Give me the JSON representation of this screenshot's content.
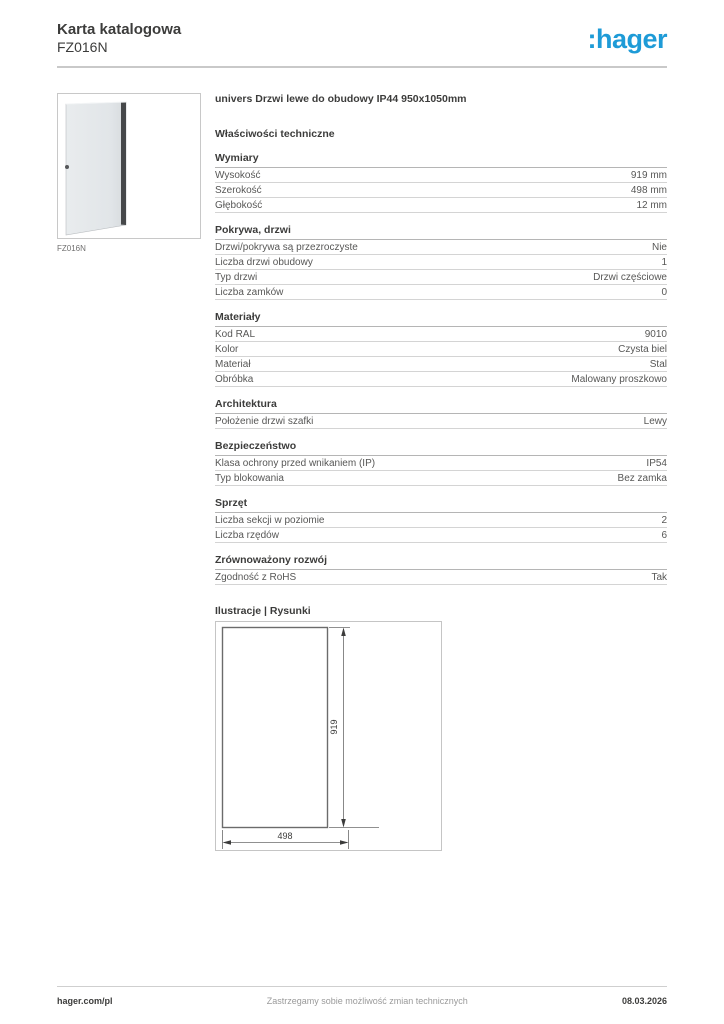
{
  "page": {
    "title": "Karta katalogowa",
    "product_code": "FZ016N",
    "brand": {
      "logo_text": ":hager",
      "color": "#1e9bd7"
    }
  },
  "product": {
    "image_caption": "FZ016N",
    "title": "univers Drzwi lewe do obudowy IP44 950x1050mm"
  },
  "specs": {
    "heading": "Właściwości techniczne",
    "sections": [
      {
        "title": "Wymiary",
        "rows": [
          {
            "label": "Wysokość",
            "value": "919 mm"
          },
          {
            "label": "Szerokość",
            "value": "498 mm"
          },
          {
            "label": "Głębokość",
            "value": "12 mm"
          }
        ]
      },
      {
        "title": "Pokrywa, drzwi",
        "rows": [
          {
            "label": "Drzwi/pokrywa są przezroczyste",
            "value": "Nie"
          },
          {
            "label": "Liczba drzwi obudowy",
            "value": "1"
          },
          {
            "label": "Typ drzwi",
            "value": "Drzwi częściowe"
          },
          {
            "label": "Liczba zamków",
            "value": "0"
          }
        ]
      },
      {
        "title": "Materiały",
        "rows": [
          {
            "label": "Kod RAL",
            "value": "9010"
          },
          {
            "label": "Kolor",
            "value": "Czysta biel"
          },
          {
            "label": "Materiał",
            "value": "Stal"
          },
          {
            "label": "Obróbka",
            "value": "Malowany proszkowo"
          }
        ]
      },
      {
        "title": "Architektura",
        "rows": [
          {
            "label": "Położenie drzwi szafki",
            "value": "Lewy"
          }
        ]
      },
      {
        "title": "Bezpieczeństwo",
        "rows": [
          {
            "label": "Klasa ochrony przed wnikaniem (IP)",
            "value": "IP54"
          },
          {
            "label": "Typ blokowania",
            "value": "Bez zamka"
          }
        ]
      },
      {
        "title": "Sprzęt",
        "rows": [
          {
            "label": "Liczba sekcji w poziomie",
            "value": "2"
          },
          {
            "label": "Liczba rzędów",
            "value": "6"
          }
        ]
      },
      {
        "title": "Zrównoważony rozwój",
        "rows": [
          {
            "label": "Zgodność z RoHS",
            "value": "Tak"
          }
        ]
      }
    ]
  },
  "illustrations": {
    "heading": "Ilustracje | Rysunki",
    "drawing": {
      "height_label": "919",
      "width_label": "498"
    }
  },
  "footer": {
    "site": "hager.com/pl",
    "disclaimer": "Zastrzegamy sobie możliwość zmian technicznych",
    "date": "08.03.2026"
  }
}
